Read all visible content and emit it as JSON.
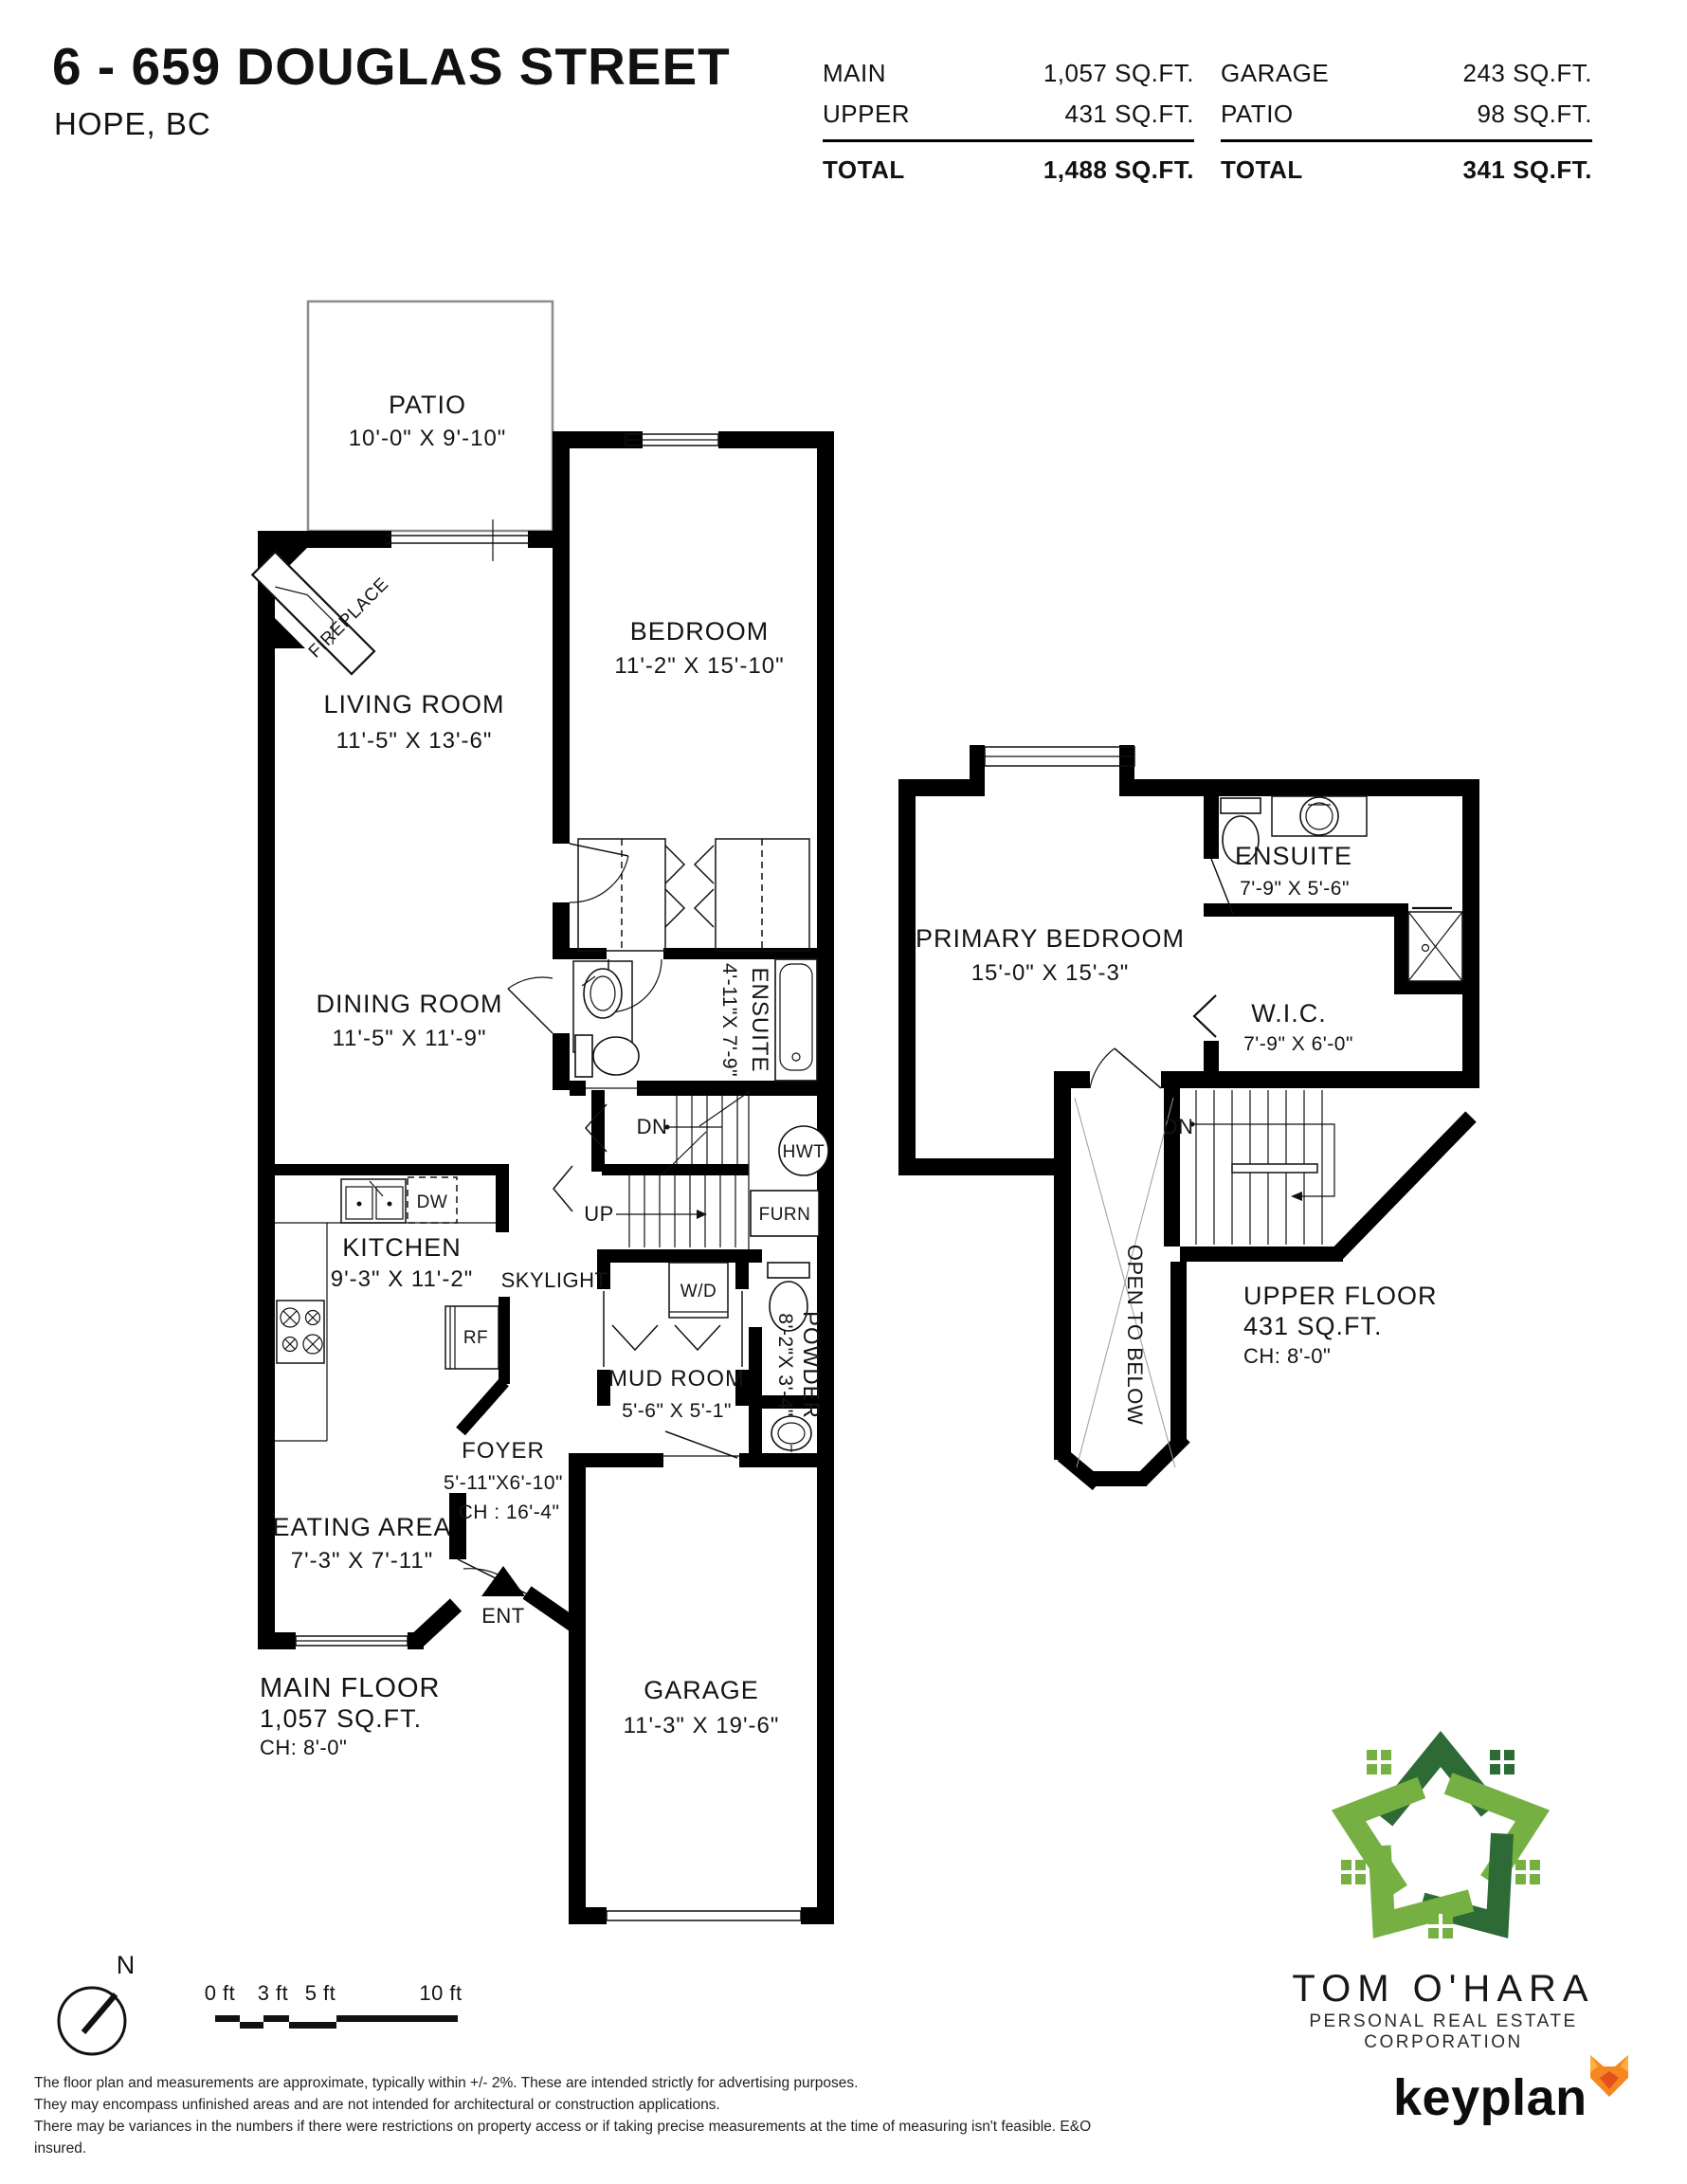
{
  "header": {
    "title": "6 - 659 DOUGLAS STREET",
    "city": "HOPE, BC"
  },
  "area_table": {
    "left": {
      "rows": [
        {
          "label": "MAIN",
          "value": "1,057 SQ.FT."
        },
        {
          "label": "UPPER",
          "value": "431 SQ.FT."
        }
      ],
      "total_label": "TOTAL",
      "total_value": "1,488 SQ.FT."
    },
    "right": {
      "rows": [
        {
          "label": "GARAGE",
          "value": "243 SQ.FT."
        },
        {
          "label": "PATIO",
          "value": "98 SQ.FT."
        }
      ],
      "total_label": "TOTAL",
      "total_value": "341 SQ.FT."
    }
  },
  "main_floor": {
    "patio": {
      "name": "PATIO",
      "dims": "10'-0\" X 9'-10\""
    },
    "bedroom": {
      "name": "BEDROOM",
      "dims": "11'-2\" X 15'-10\""
    },
    "living": {
      "name": "LIVING ROOM",
      "dims": "11'-5\" X 13'-6\""
    },
    "dining": {
      "name": "DINING ROOM",
      "dims": "11'-5\" X 11'-9\""
    },
    "ensuite": {
      "name": "ENSUITE",
      "dims": "4'-11\"X 7'-9\""
    },
    "kitchen": {
      "name": "KITCHEN",
      "dims": "9'-3\" X 11'-2\""
    },
    "mudroom": {
      "name": "MUD ROOM",
      "dims": "5'-6\" X 5'-1\""
    },
    "powder": {
      "name": "POWDER",
      "dims": "8'-2\"X 3'-4\""
    },
    "foyer": {
      "name": "FOYER",
      "dims": "5'-11\"X6'-10\"",
      "ch": "CH : 16'-4\""
    },
    "eating": {
      "name": "EATING AREA",
      "dims": "7'-3\" X 7'-11\""
    },
    "garage": {
      "name": "GARAGE",
      "dims": "11'-3\" X 19'-6\""
    },
    "fireplace": "FIREPLACE",
    "skylight": "SKYLIGHT",
    "ent": "ENT",
    "up": "UP",
    "dn": "DN",
    "hwt": "HWT",
    "furn": "FURN",
    "wd": "W/D",
    "dw": "DW",
    "rf": "RF",
    "floor_name": "MAIN FLOOR",
    "floor_area": "1,057 SQ.FT.",
    "floor_ch": "CH: 8'-0\""
  },
  "upper_floor": {
    "primary": {
      "name": "PRIMARY BEDROOM",
      "dims": "15'-0\" X 15'-3\""
    },
    "ensuite": {
      "name": "ENSUITE",
      "dims": "7'-9\" X 5'-6\""
    },
    "wic": {
      "name": "W.I.C.",
      "dims": "7'-9\" X 6'-0\""
    },
    "open_below": "OPEN TO BELOW",
    "dn": "DN",
    "floor_name": "UPPER FLOOR",
    "floor_area": "431 SQ.FT.",
    "floor_ch": "CH: 8'-0\""
  },
  "footer": {
    "north_label": "N",
    "scale_labels": [
      "0 ft",
      "3 ft",
      "5 ft",
      "10 ft"
    ],
    "disclaimer": [
      "The floor plan and measurements are approximate, typically within +/- 2%. These are intended strictly for advertising purposes.",
      "They may encompass unfinished areas and are not intended for architectural or construction applications.",
      "There may be variances in the numbers if there were restrictions on property access or if taking precise measurements at the time of measuring isn't feasible. E&O insured."
    ],
    "brand": {
      "name": "TOM O'HARA",
      "tagline": "PERSONAL REAL ESTATE CORPORATION"
    },
    "keyplan_label": "keyplan",
    "colors": {
      "logo_light_green": "#76b043",
      "logo_dark_green": "#2d6a35",
      "keyplan_orange": "#f6861f"
    }
  }
}
